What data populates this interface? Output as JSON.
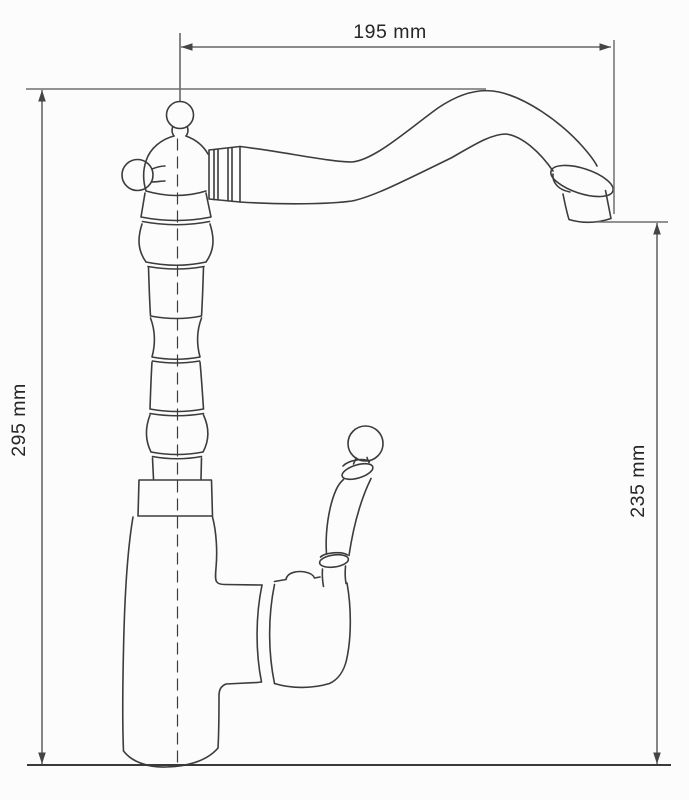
{
  "page": {
    "background": "#fcfcfc",
    "width": 689,
    "height": 800
  },
  "diagram": {
    "type": "technical_dimension_drawing",
    "subject": "single-lever kitchen faucet with high curved spout, side elevation line drawing",
    "style": {
      "line_color": "#3c3c3c",
      "dimension_color": "#454545",
      "extension_color": "#6e6e6e",
      "text_color": "#262626",
      "background": "#fcfcfc"
    },
    "dimensions": {
      "spout_reach": {
        "label": "195 mm",
        "value": 195,
        "unit": "mm",
        "orientation": "horizontal",
        "measures": "horizontal distance from faucet vertical axis to spout outlet"
      },
      "overall_height": {
        "label": "295 mm",
        "value": 295,
        "unit": "mm",
        "orientation": "vertical",
        "measures": "overall height from mounting base to top of spout arch"
      },
      "outlet_height": {
        "label": "235 mm",
        "value": 235,
        "unit": "mm",
        "orientation": "vertical",
        "measures": "height from mounting base to spout outlet"
      }
    },
    "parts": [
      "ball-finial",
      "side-cross-knob",
      "valve-dome",
      "ribbed-coupling",
      "swan-neck-spout",
      "spout-collar-ring",
      "spout-outlet",
      "turned-column",
      "column-collar-block",
      "base-body",
      "lever-handle-ball",
      "lever-handle-grip",
      "cartridge-housing",
      "mounting-baseline",
      "center-axis-dashed"
    ]
  }
}
